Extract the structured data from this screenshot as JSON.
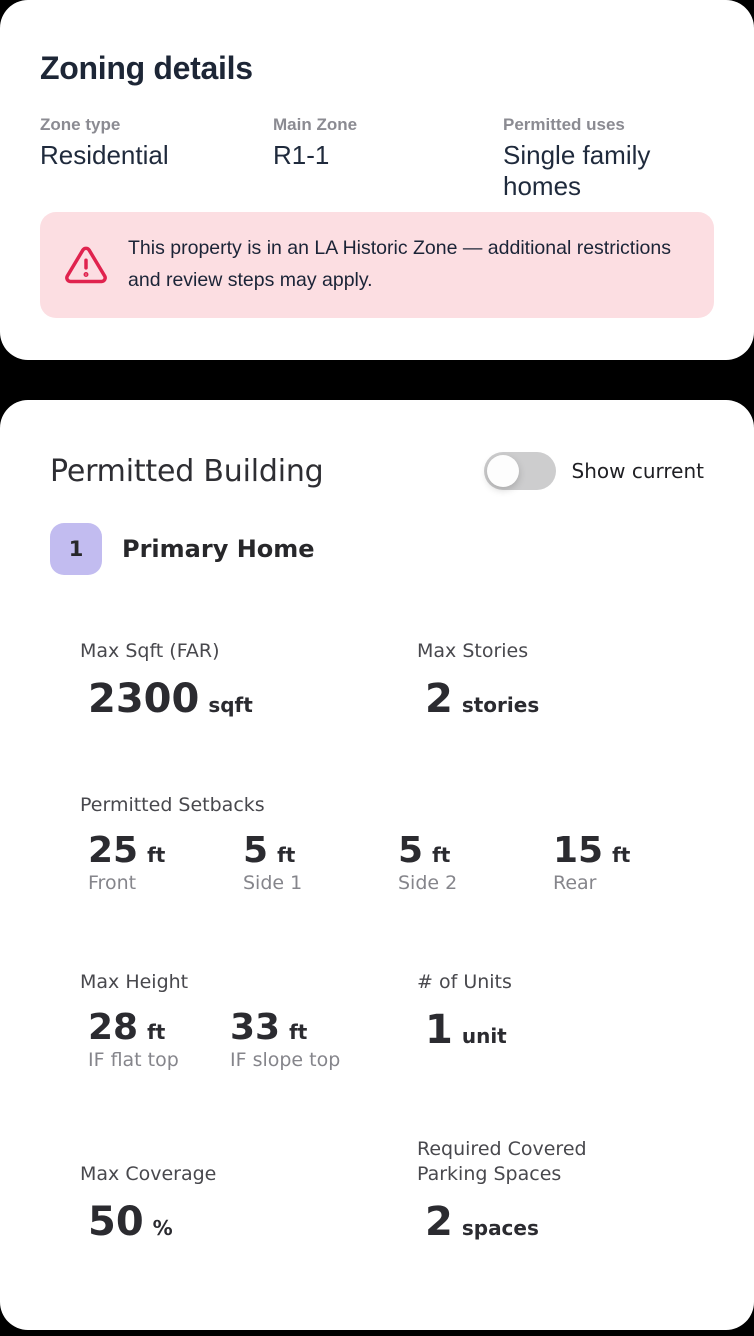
{
  "colors": {
    "page_background": "#000000",
    "card_background": "#ffffff",
    "warning_background": "#fcdee2",
    "warning_icon": "#e0234e",
    "badge_background": "#c2bcf0",
    "heading_navy": "#1d2636"
  },
  "zoning_card": {
    "title": "Zoning details",
    "fields": [
      {
        "label": "Zone type",
        "value": "Residential"
      },
      {
        "label": "Main Zone",
        "value": "R1-1"
      },
      {
        "label": "Permitted uses",
        "value": "Single family homes"
      }
    ],
    "warning": {
      "icon": "warning-triangle-icon",
      "text": "This property is in an LA Historic Zone — additional restrictions and review steps may apply."
    }
  },
  "permitted_card": {
    "title": "Permitted Building",
    "toggle": {
      "label": "Show current",
      "state": "off"
    },
    "building": {
      "index": "1",
      "name": "Primary Home"
    },
    "stats": {
      "max_sqft": {
        "label": "Max Sqft (FAR)",
        "value": "2300",
        "unit": "sqft"
      },
      "max_stories": {
        "label": "Max Stories",
        "value": "2",
        "unit": "stories"
      },
      "setbacks": {
        "label": "Permitted Setbacks",
        "items": [
          {
            "value": "25",
            "unit": "ft",
            "name": "Front"
          },
          {
            "value": "5",
            "unit": "ft",
            "name": "Side 1"
          },
          {
            "value": "5",
            "unit": "ft",
            "name": "Side 2"
          },
          {
            "value": "15",
            "unit": "ft",
            "name": "Rear"
          }
        ]
      },
      "max_height": {
        "label": "Max Height",
        "items": [
          {
            "value": "28",
            "unit": "ft",
            "name": "IF flat top"
          },
          {
            "value": "33",
            "unit": "ft",
            "name": "IF slope top"
          }
        ]
      },
      "units": {
        "label": "# of Units",
        "value": "1",
        "unit": "unit"
      },
      "max_coverage": {
        "label": "Max Coverage",
        "value": "50",
        "unit": "%"
      },
      "parking": {
        "label": "Required Covered Parking Spaces",
        "value": "2",
        "unit": "spaces"
      }
    }
  }
}
